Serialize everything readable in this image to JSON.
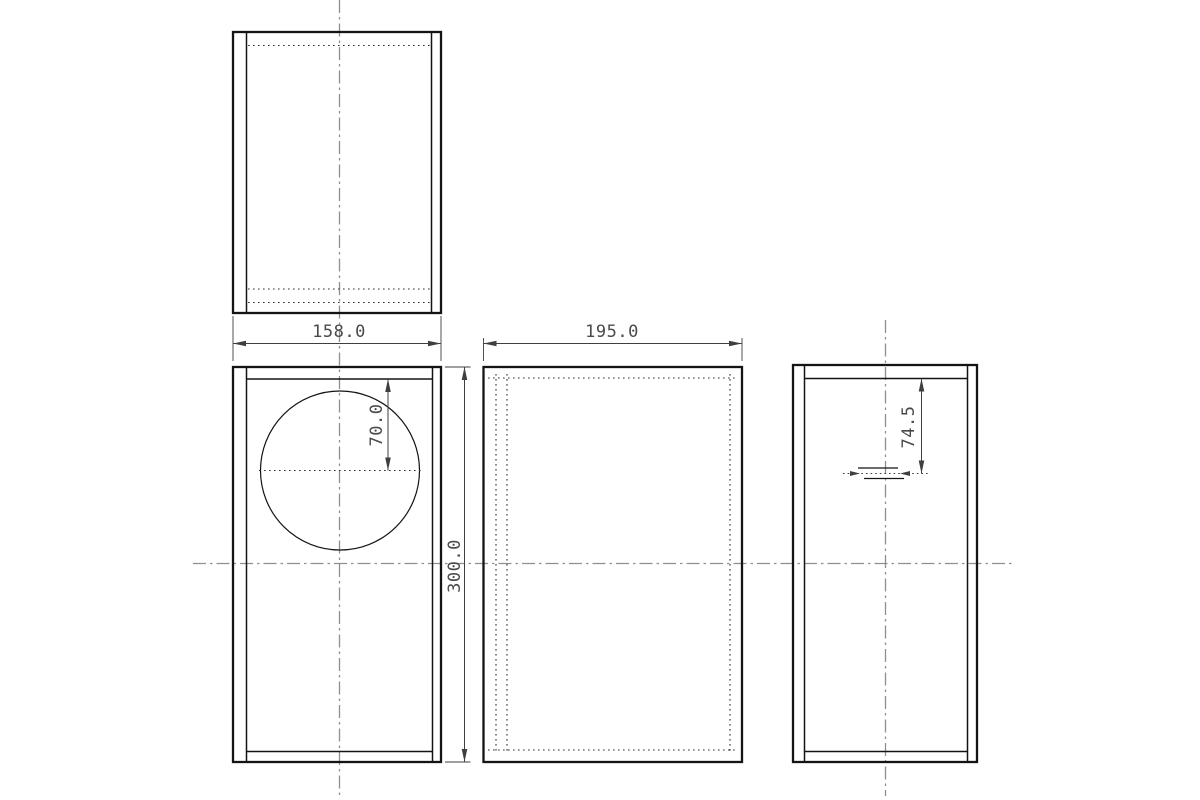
{
  "drawing": {
    "title": "speaker-enclosure-orthographic-drawing",
    "dimensions": {
      "front_width": "158.0",
      "cabinet_depth": "195.0",
      "cabinet_height": "300.0",
      "driver_center_from_top": "70.0",
      "terminal_from_top": "74.5"
    },
    "colors": {
      "object_line": "#141414",
      "hidden_line": "#2f2f2f",
      "center_line": "#8f8f8f",
      "dimension_line": "#3f3f3f",
      "dimension_text": "#4a4a4a",
      "background": "#ffffff"
    }
  }
}
